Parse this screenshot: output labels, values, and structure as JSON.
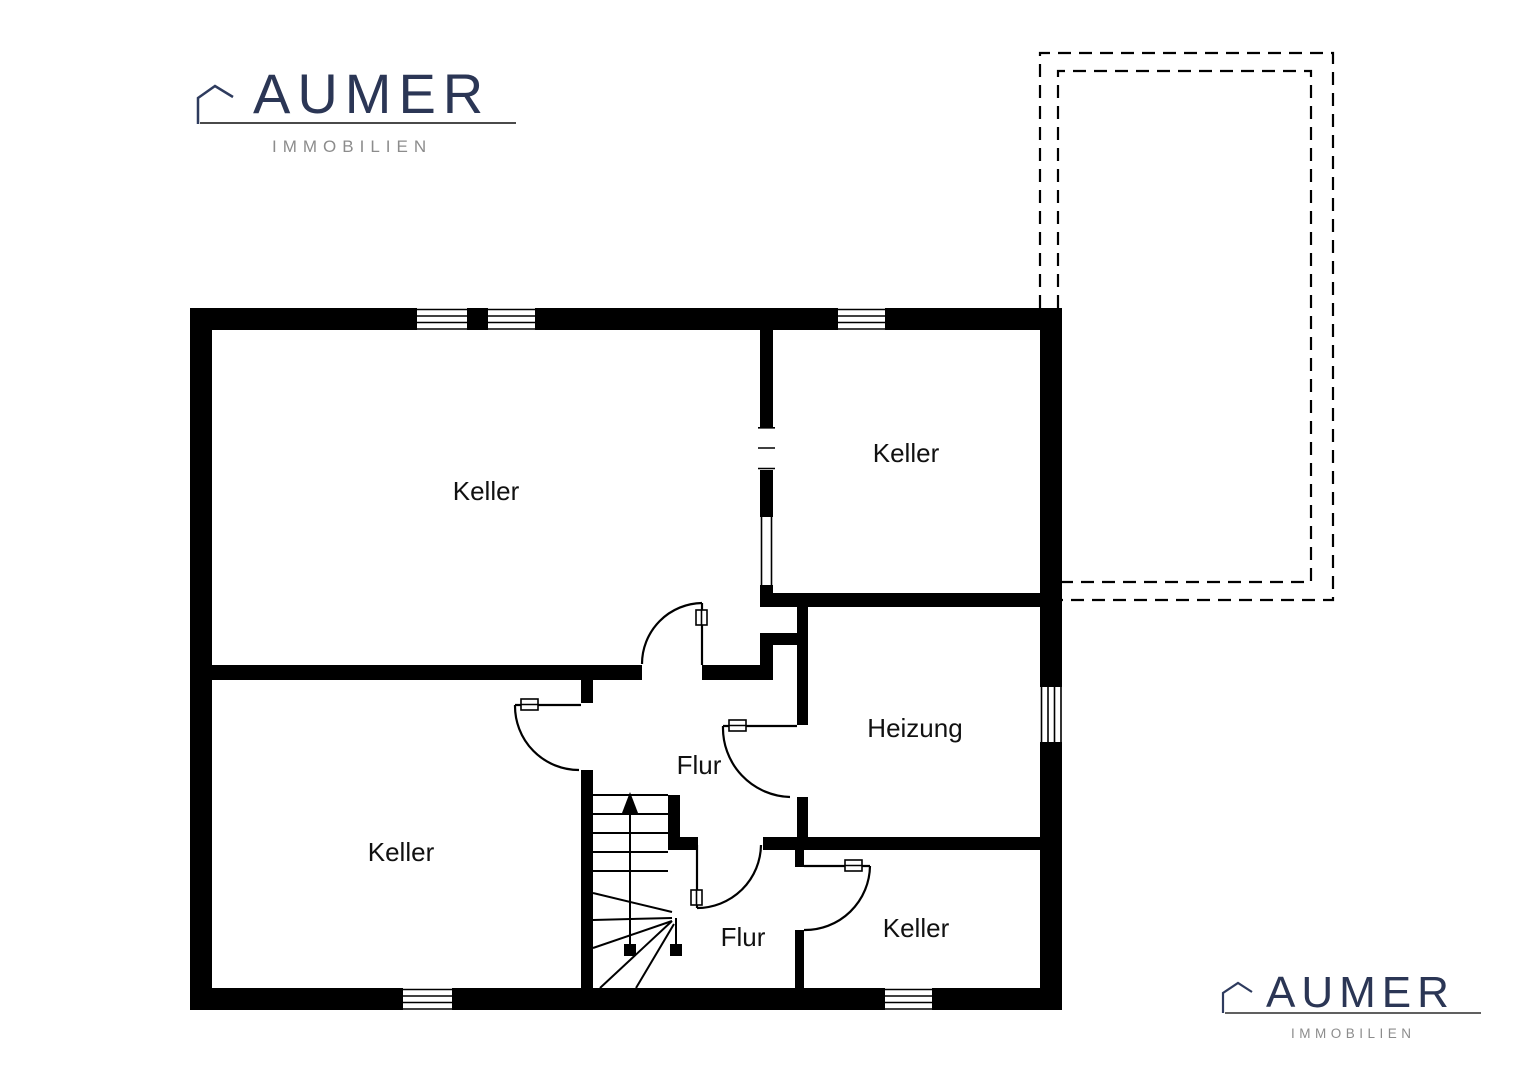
{
  "branding": {
    "top_logo": {
      "title": "AUMER",
      "subtitle": "IMMOBILIEN"
    },
    "bottom_logo": {
      "title": "AUMER",
      "subtitle": "IMMOBILIEN"
    },
    "colors": {
      "navy": "#2b3655",
      "gray": "#8c8c8c",
      "wall": "#000000"
    }
  },
  "floorplan": {
    "rooms": [
      {
        "id": "keller-top-left",
        "label": "Keller"
      },
      {
        "id": "keller-top-right",
        "label": "Keller"
      },
      {
        "id": "heizung",
        "label": "Heizung"
      },
      {
        "id": "flur-upper",
        "label": "Flur"
      },
      {
        "id": "keller-bottom-left",
        "label": "Keller"
      },
      {
        "id": "flur-lower",
        "label": "Flur"
      },
      {
        "id": "keller-bottom-right",
        "label": "Keller"
      }
    ],
    "symbols": {
      "window": "window-symbol",
      "door": "door-swing-symbol",
      "stairs": "staircase-symbol",
      "stair_arrow": "stair-direction-arrow",
      "terrace": "terrace-dashed-outline",
      "logo_house": "house-icon"
    }
  }
}
